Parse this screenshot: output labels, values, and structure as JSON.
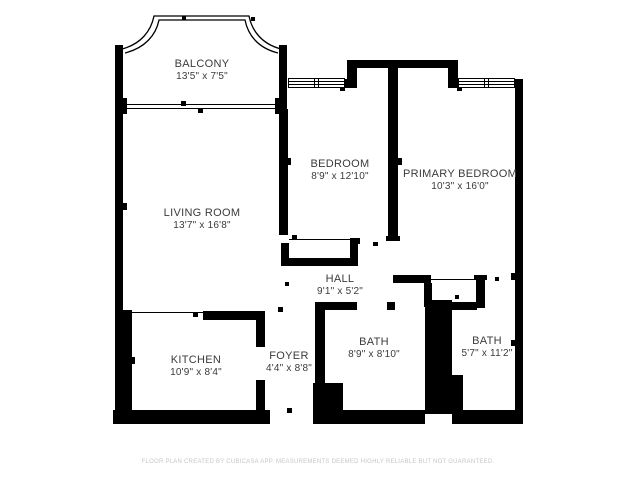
{
  "floor_plan": {
    "rooms": [
      {
        "id": "balcony",
        "name": "BALCONY",
        "dims": "13'5\" x 7'5\""
      },
      {
        "id": "living-room",
        "name": "LIVING ROOM",
        "dims": "13'7\" x 16'8\""
      },
      {
        "id": "bedroom",
        "name": "BEDROOM",
        "dims": "8'9\" x 12'10\""
      },
      {
        "id": "primary-bedroom",
        "name": "PRIMARY BEDROOM",
        "dims": "10'3\" x 16'0\""
      },
      {
        "id": "hall",
        "name": "HALL",
        "dims": "9'1\" x 5'2\""
      },
      {
        "id": "kitchen",
        "name": "KITCHEN",
        "dims": "10'9\" x 8'4\""
      },
      {
        "id": "foyer",
        "name": "FOYER",
        "dims": "4'4\" x 8'8\""
      },
      {
        "id": "bath-1",
        "name": "BATH",
        "dims": "8'9\" x 8'10\""
      },
      {
        "id": "bath-2",
        "name": "BATH",
        "dims": "5'7\" x 11'2\""
      }
    ],
    "footer": "FLOOR PLAN CREATED BY CUBICASA APP. MEASUREMENTS DEEMED HIGHLY RELIABLE BUT NOT GUARANTEED.",
    "colors": {
      "wall": "#000000",
      "text": "#3b3b3b",
      "footer": "#c6c6c6",
      "background": "#ffffff"
    }
  }
}
